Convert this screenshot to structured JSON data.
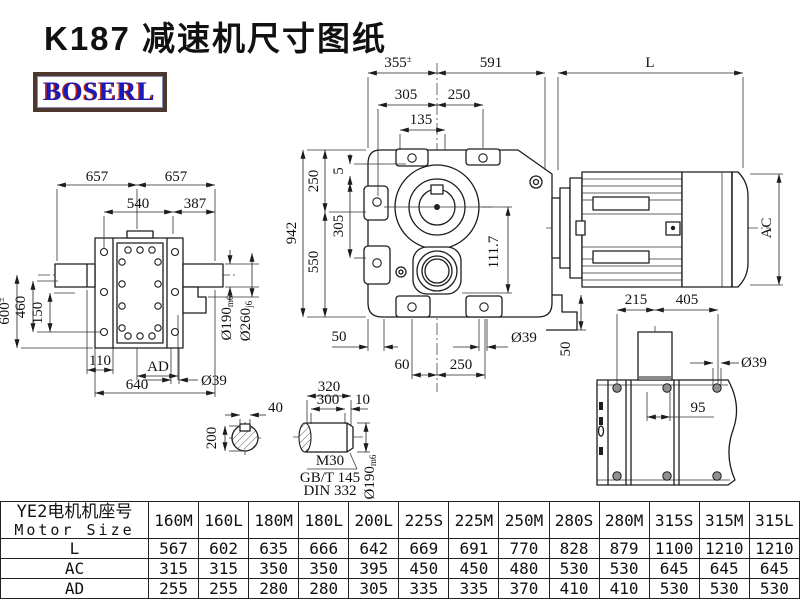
{
  "page": {
    "title": "K187 减速机尺寸图纸",
    "logo": "BOSERL"
  },
  "labels": {
    "main_355": "355",
    "main_355_tol": "±",
    "main_591": "591",
    "main_L": "L",
    "main_305_top": "305",
    "main_250_top": "250",
    "main_135": "135",
    "main_942": "942",
    "main_250_left": "250",
    "main_550_left": "550",
    "main_5": "5",
    "main_305_left": "305",
    "main_111_7": "111.7",
    "main_50_bottom": "50",
    "main_60": "60",
    "main_250_bottom": "250",
    "main_d39": "Ø39",
    "main_50_right": "50",
    "left_657_a": "657",
    "left_657_b": "657",
    "left_540": "540",
    "left_387": "387",
    "left_600": "600",
    "left_600_tol": "±",
    "left_460": "460",
    "left_150": "150",
    "left_110": "110",
    "left_ad": "AD",
    "left_640": "640",
    "left_d39": "Ø39",
    "left_d190": "Ø190",
    "left_d190_fit": "m6",
    "left_d260": "Ø260",
    "left_d260_fit": "j6",
    "motor_ac": "AC",
    "base_215": "215",
    "base_405": "405",
    "base_95": "95",
    "base_d39": "Ø39",
    "sec_40": "40",
    "sec_200": "200",
    "shaft_320": "320",
    "shaft_300": "300",
    "shaft_10": "10",
    "shaft_m30": "M30",
    "shaft_gbt": "GB/T 145",
    "shaft_din": "DIN 332",
    "shaft_d190": "Ø190",
    "shaft_d190_fit": "m6"
  },
  "table": {
    "header_cn": "YE2电机机座号",
    "header_en": "Motor Size",
    "columns": [
      "160M",
      "160L",
      "180M",
      "180L",
      "200L",
      "225S",
      "225M",
      "250M",
      "280S",
      "280M",
      "315S",
      "315M",
      "315L"
    ],
    "rows": [
      {
        "label": "L",
        "values": [
          "567",
          "602",
          "635",
          "666",
          "642",
          "669",
          "691",
          "770",
          "828",
          "879",
          "1100",
          "1210",
          "1210"
        ]
      },
      {
        "label": "AC",
        "values": [
          "315",
          "315",
          "350",
          "350",
          "395",
          "450",
          "450",
          "480",
          "530",
          "530",
          "645",
          "645",
          "645"
        ]
      },
      {
        "label": "AD",
        "values": [
          "255",
          "255",
          "280",
          "280",
          "305",
          "335",
          "335",
          "370",
          "410",
          "410",
          "530",
          "530",
          "530"
        ]
      }
    ]
  }
}
